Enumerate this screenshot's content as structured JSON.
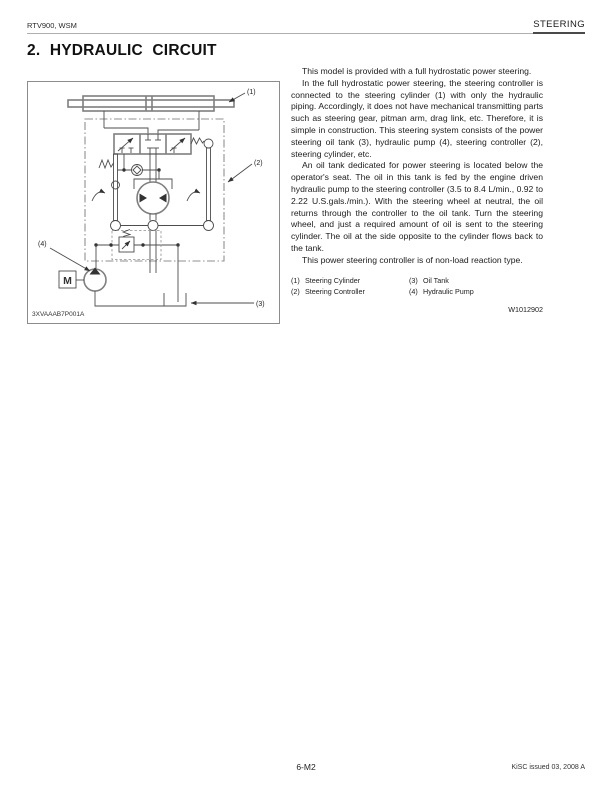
{
  "header": {
    "left": "RTV900, WSM",
    "right": "STEERING"
  },
  "title": "2. HYDRAULIC CIRCUIT",
  "figure": {
    "code": "3XVAAAB7P001A",
    "motor": "M",
    "callouts": {
      "c1": "(1)",
      "c2": "(2)",
      "c3": "(3)",
      "c4": "(4)"
    }
  },
  "body": {
    "p1": "This model is provided with a full hydrostatic power steering.",
    "p2": "In the full hydrostatic power steering, the steering controller is connected to the steering cylinder (1) with only the hydraulic piping.  Accordingly, it does not have mechanical transmitting parts such as steering gear, pitman arm, drag link, etc.  Therefore, it is simple in construction. This steering system consists of the power steering oil tank (3), hydraulic pump (4), steering controller (2), steering cylinder, etc.",
    "p3": "An oil tank dedicated for power steering is located below the operator's seat.  The oil in this tank is fed by the engine driven hydraulic pump to the steering controller (3.5 to 8.4 L/min., 0.92 to 2.22 U.S.gals./min.). With the steering wheel at neutral, the oil returns through the controller to the oil tank.  Turn the steering wheel, and just a required amount of oil is sent to the steering cylinder.  The oil at the side opposite to the cylinder flows back to the tank.",
    "p4": "This power steering controller is of non-load reaction type."
  },
  "legend": [
    {
      "num": "(1)",
      "label": "Steering Cylinder"
    },
    {
      "num": "(2)",
      "label": "Steering Controller"
    },
    {
      "num": "(3)",
      "label": "Oil Tank"
    },
    {
      "num": "(4)",
      "label": "Hydraulic Pump"
    }
  ],
  "ref": "W1012902",
  "footer": {
    "page": "6-M2",
    "right": "KiSC issued 03, 2008 A"
  }
}
